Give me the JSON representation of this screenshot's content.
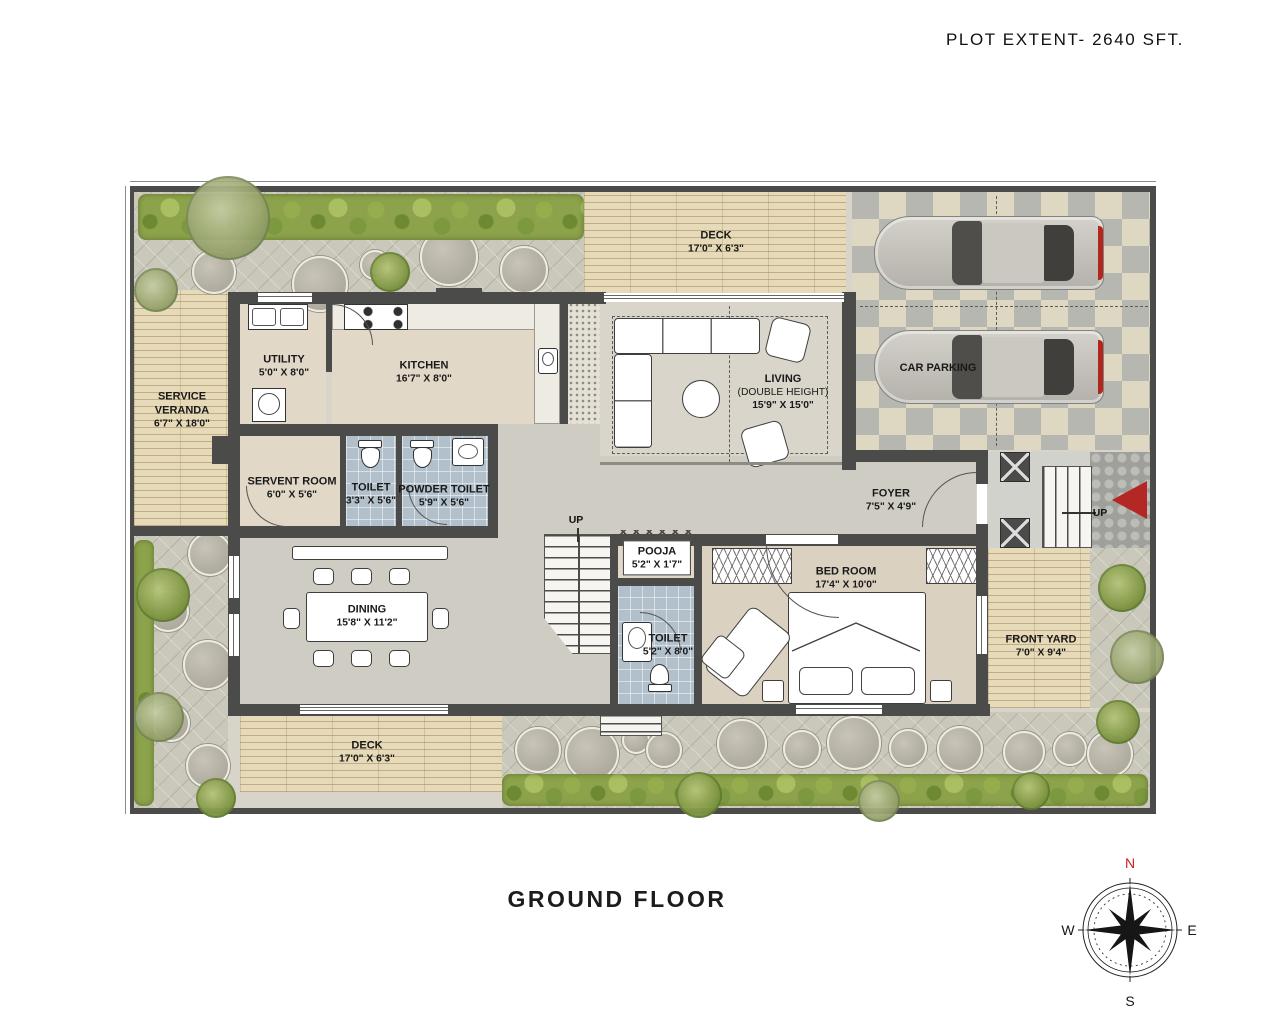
{
  "title": {
    "plot_extent": "PLOT EXTENT- 2640 SFT.",
    "floor": "GROUND FLOOR"
  },
  "compass": {
    "n": "N",
    "e": "E",
    "s": "S",
    "w": "W"
  },
  "labels": {
    "up_stairs": "UP",
    "up_entry": "UP"
  },
  "rooms": {
    "deck_top": {
      "name": "DECK",
      "dims": "17'0\" X 6'3\""
    },
    "car_parking": {
      "name": "CAR PARKING"
    },
    "service_veranda": {
      "name": "SERVICE VERANDA",
      "dims": "6'7\" X 18'0\""
    },
    "utility": {
      "name": "UTILITY",
      "dims": "5'0\" X 8'0\""
    },
    "kitchen": {
      "name": "KITCHEN",
      "dims": "16'7\" X 8'0\""
    },
    "living": {
      "name": "LIVING",
      "sub": "(DOUBLE HEIGHT)",
      "dims": "15'9\" X 15'0\""
    },
    "servent_room": {
      "name": "SERVENT ROOM",
      "dims": "6'0\" X 5'6\""
    },
    "toilet_servant": {
      "name": "TOILET",
      "dims": "3'3\" X 5'6\""
    },
    "powder_toilet": {
      "name": "POWDER TOILET",
      "dims": "5'9\" X 5'6\""
    },
    "foyer": {
      "name": "FOYER",
      "dims": "7'5\" X 4'9\""
    },
    "pooja": {
      "name": "POOJA",
      "dims": "5'2\" X 1'7\""
    },
    "dining": {
      "name": "DINING",
      "dims": "15'8\" X 11'2\""
    },
    "toilet_bedroom": {
      "name": "TOILET",
      "dims": "5'2\" X 8'0\""
    },
    "bedroom": {
      "name": "BED ROOM",
      "dims": "17'4\" X 10'0\""
    },
    "front_yard": {
      "name": "FRONT YARD",
      "dims": "7'0\" X 9'4\""
    },
    "deck_bottom": {
      "name": "DECK",
      "dims": "17'0\" X 6'3\""
    }
  },
  "colors": {
    "wall": "#4b4b49",
    "accent_red": "#b32724",
    "compass_north": "#cc1f1f",
    "tile_blue": "#b2c0cb",
    "wood": "#e7dab8",
    "hedge_green": "#8ca24b"
  }
}
